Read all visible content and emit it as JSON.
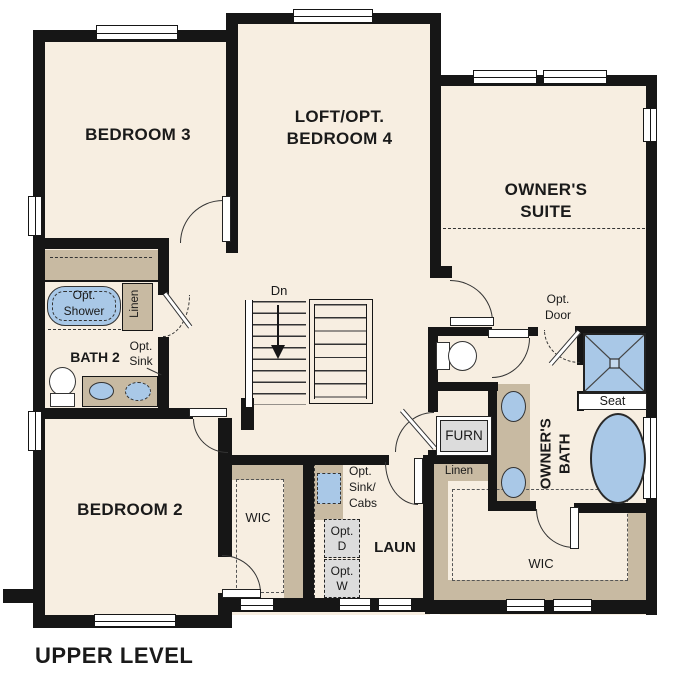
{
  "plan_title": "UPPER LEVEL",
  "labels": {
    "bedroom3": "BEDROOM 3",
    "loft": "LOFT/OPT.\nBEDROOM 4",
    "owners_suite": "OWNER'S\nSUITE",
    "bedroom2": "BEDROOM 2",
    "bath2": "BATH 2",
    "owners_bath": "OWNER'S\nBATH",
    "laundry": "LAUN",
    "wic_bedroom2": "WIC",
    "wic_owners": "WIC",
    "stairs_dn": "Dn",
    "opt_shower": "Opt.\nShower",
    "linen_left": "Linen",
    "linen_right": "Linen",
    "opt_sink": "Opt.\nSink",
    "opt_door": "Opt.\nDoor",
    "furn": "FURN",
    "seat": "Seat",
    "opt_sink_cabs": "Opt.\nSink/\nCabs",
    "opt_dryer": "Opt.\nD",
    "opt_washer": "Opt.\nW"
  },
  "colors": {
    "wall": "#161616",
    "floor": "#f7eee1",
    "cabinet_tan": "#c8baa2",
    "fixture_blue": "#a9c8e7",
    "optional_gray": "#dcdcdc"
  }
}
